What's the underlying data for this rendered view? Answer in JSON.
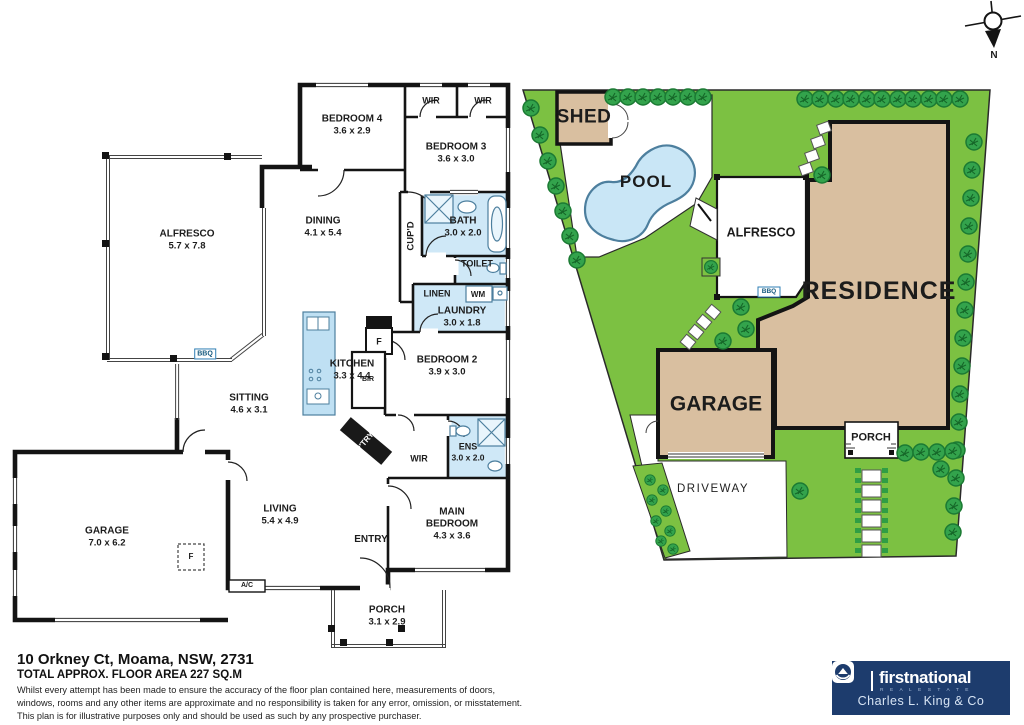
{
  "floor_plan": {
    "rooms": {
      "bedroom4": {
        "name": "BEDROOM 4",
        "dims": "3.6 x 2.9"
      },
      "wir_top_left": {
        "name": "WIR"
      },
      "wir_top_right": {
        "name": "WIR"
      },
      "bedroom3": {
        "name": "BEDROOM 3",
        "dims": "3.6 x 3.0"
      },
      "dining": {
        "name": "DINING",
        "dims": "4.1 x 5.4"
      },
      "alfresco": {
        "name": "ALFRESCO",
        "dims": "5.7 x 7.8"
      },
      "bbq": {
        "name": "BBQ"
      },
      "cupd": {
        "name": "CUP'D"
      },
      "bath": {
        "name": "BATH",
        "dims": "3.0 x 2.0"
      },
      "toilet": {
        "name": "TOILET"
      },
      "linen": {
        "name": "LINEN"
      },
      "wm": {
        "name": "WM"
      },
      "laundry": {
        "name": "LAUNDRY",
        "dims": "3.0 x 1.8"
      },
      "kitchen": {
        "name": "KITCHEN",
        "dims": "3.3 x 4.4"
      },
      "fridge": {
        "name": "F"
      },
      "bir": {
        "name": "BIR"
      },
      "bedroom2": {
        "name": "BEDROOM 2",
        "dims": "3.9 x 3.0"
      },
      "pantry": {
        "name": "P'TRY"
      },
      "wir_main": {
        "name": "WIR"
      },
      "ens": {
        "name": "ENS",
        "dims": "3.0 x 2.0"
      },
      "sitting": {
        "name": "SITTING",
        "dims": "4.6 x 3.1"
      },
      "garage": {
        "name": "GARAGE",
        "dims": "7.0 x 6.2"
      },
      "garage_fridge": {
        "name": "F"
      },
      "ac": {
        "name": "A/C"
      },
      "living": {
        "name": "LIVING",
        "dims": "5.4 x 4.9"
      },
      "entry": {
        "name": "ENTRY"
      },
      "main_bedroom": {
        "name": "MAIN BEDROOM",
        "dims": "4.3 x 3.6"
      },
      "porch": {
        "name": "PORCH",
        "dims": "3.1 x 2.9"
      }
    }
  },
  "site_plan": {
    "labels": {
      "shed": "SHED",
      "pool": "POOL",
      "alfresco": "ALFRESCO",
      "residence": "RESIDENCE",
      "garage": "GARAGE",
      "porch": "PORCH",
      "driveway": "DRIVEWAY",
      "bbq": "BBQ"
    }
  },
  "compass": {
    "north_label": "N"
  },
  "footer": {
    "address": "10 Orkney Ct, Moama, NSW, 2731",
    "floor_area": "TOTAL APPROX. FLOOR AREA 227 SQ.M",
    "disclaimer_line1": "Whilst every attempt has been made to ensure the accuracy of the floor plan contained here, measurements of doors,",
    "disclaimer_line2": "windows, rooms and any other items are approximate and no responsibility is taken for any error, omission, or misstatement.",
    "disclaimer_line3": "This plan is for illustrative purposes only and should be used as such by any prospective purchaser."
  },
  "brand": {
    "name": "firstnational",
    "tagline": "R E A L   E S T A T E",
    "agency": "Charles L. King & Co"
  },
  "colors": {
    "lawn": "#7cc142",
    "bush": "#2f9e44",
    "building": "#d9bfa0",
    "pool": "#c9e6f6",
    "wet_area": "#cfe8f7",
    "logo_navy": "#1d3c6d"
  }
}
